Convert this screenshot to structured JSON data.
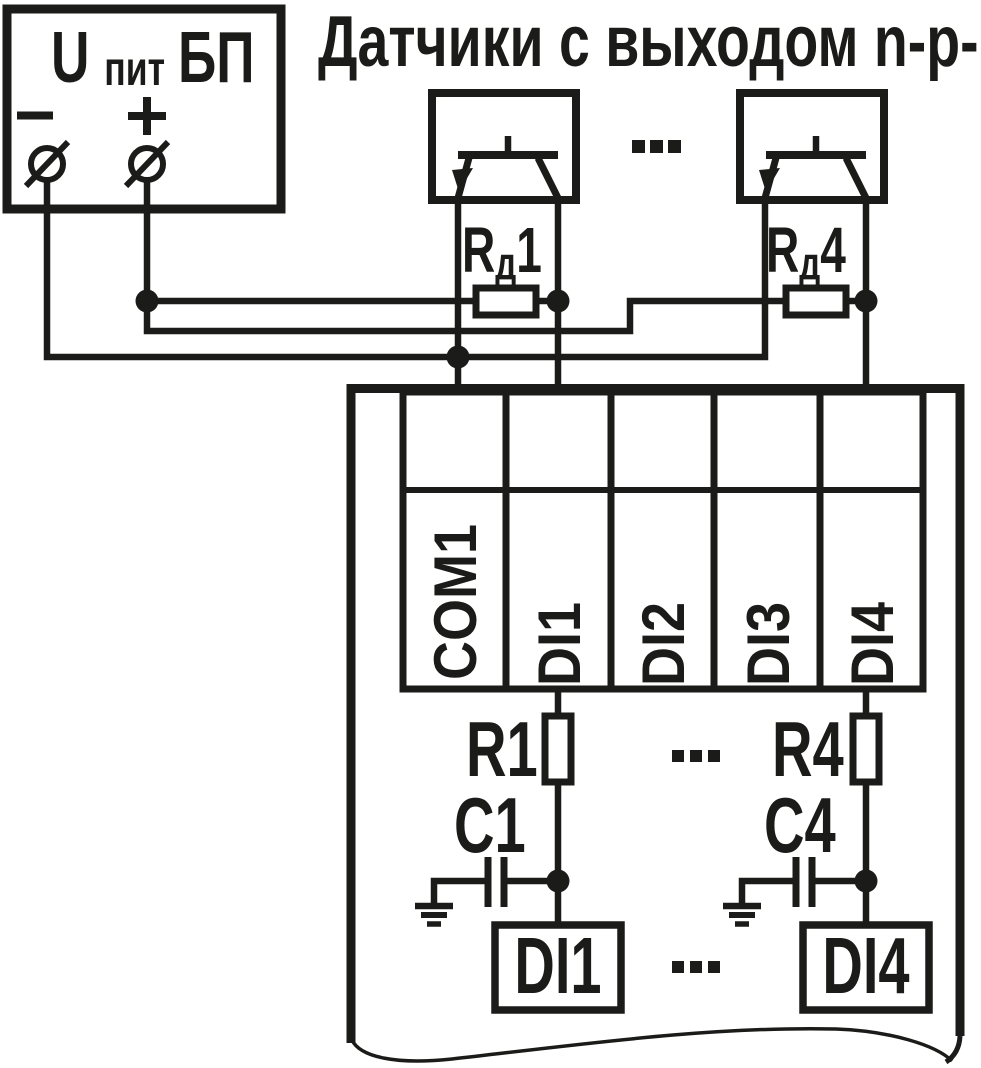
{
  "title": "Датчики с выходом n-p-n",
  "power_supply": {
    "name": "БП",
    "voltage": {
      "base": "U",
      "sub": "пит"
    },
    "minus_label": "–",
    "plus_label": "+"
  },
  "sensors": {
    "ellipsis": "..."
  },
  "divider_resistors": {
    "rd1": {
      "base": "R",
      "sub": "д",
      "index": "1"
    },
    "rd4": {
      "base": "R",
      "sub": "д",
      "index": "4"
    }
  },
  "device": {
    "terminals": [
      "COM1",
      "DI1",
      "DI2",
      "DI3",
      "DI4"
    ],
    "input_resistors": {
      "r1": "R1",
      "r4": "R4",
      "ellipsis": "..."
    },
    "filter_capacitors": {
      "c1": "C1",
      "c4": "C4"
    },
    "internal_inputs": {
      "di1": "DI1",
      "di4": "DI4",
      "ellipsis": "..."
    }
  },
  "colors": {
    "ink": "#1b1b19",
    "background": "#ffffff"
  }
}
